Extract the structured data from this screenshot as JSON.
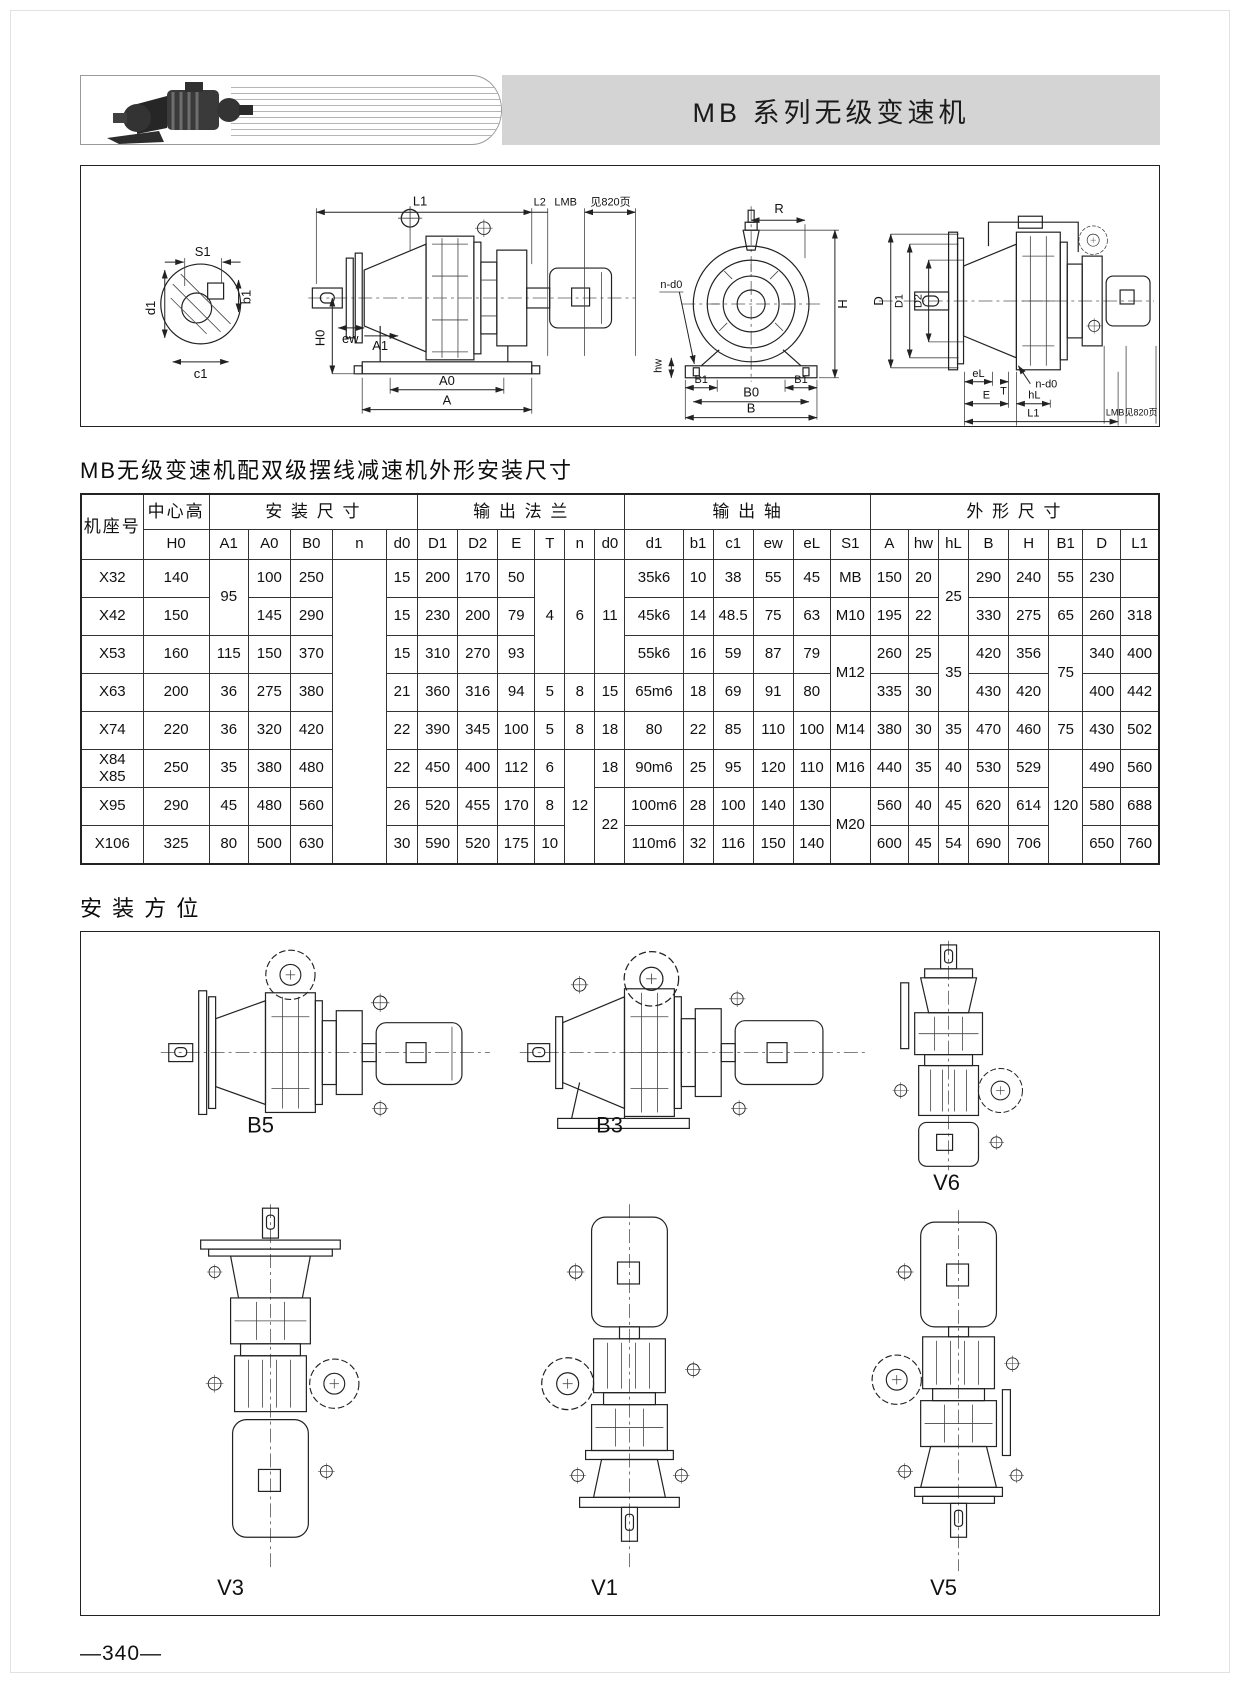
{
  "header": {
    "title": "MB 系列无级变速机"
  },
  "sections": {
    "table_title": "MB无级变速机配双级摆线减速机外形安装尺寸",
    "mounting_title": "安 装 方 位"
  },
  "diagrams": {
    "shaft_section": {
      "s1": "S1",
      "b1": "b1",
      "d1": "d1",
      "c1": "c1"
    },
    "side_view": {
      "l1": "L1",
      "l2": "L2",
      "lmb": "LMB",
      "see_page": "见820页",
      "h0": "H0",
      "ew": "ew",
      "a1": "A1",
      "a0": "A0",
      "a": "A"
    },
    "front_view": {
      "r": "R",
      "h": "H",
      "nd0": "n-d0",
      "hw": "hw",
      "b1": "B1",
      "b0": "B0",
      "b": "B"
    },
    "flange_view": {
      "d": "D",
      "d1": "D1",
      "d2": "D2",
      "el": "eL",
      "t": "T",
      "nd0": "n-d0",
      "e": "E",
      "hl": "hL",
      "lmb": "LMB",
      "see_page": "见820页",
      "l1": "L1"
    }
  },
  "table": {
    "col_model": "机座号",
    "groups": {
      "center_height": "中心高",
      "install": "安 装 尺 寸",
      "flange": "输 出 法 兰",
      "shaft": "输 出 轴",
      "outline": "外 形 尺 寸"
    },
    "sub": [
      "H0",
      "A1",
      "A0",
      "B0",
      "n",
      "d0",
      "D1",
      "D2",
      "E",
      "T",
      "n",
      "d0",
      "d1",
      "b1",
      "c1",
      "ew",
      "eL",
      "S1",
      "A",
      "hw",
      "hL",
      "B",
      "H",
      "B1",
      "D",
      "L1"
    ],
    "rows": [
      {
        "cells": [
          "X32",
          "140",
          "95",
          "100",
          "250",
          "",
          "15",
          "200",
          "170",
          "50",
          "4",
          "6",
          "11",
          "35k6",
          "10",
          "38",
          "55",
          "45",
          "MB",
          "150",
          "20",
          "25",
          "290",
          "240",
          "55",
          "230",
          ""
        ]
      },
      {
        "cells": [
          "X42",
          "150",
          "145",
          "290",
          "15",
          "230",
          "200",
          "79",
          "45k6",
          "14",
          "48.5",
          "75",
          "63",
          "M10",
          "195",
          "22",
          "330",
          "275",
          "65",
          "260",
          "318"
        ]
      },
      {
        "cells": [
          "X53",
          "160",
          "115",
          "150",
          "370",
          "15",
          "310",
          "270",
          "93",
          "55k6",
          "16",
          "59",
          "87",
          "79",
          "M12",
          "260",
          "25",
          "35",
          "420",
          "356",
          "75",
          "340",
          "400"
        ]
      },
      {
        "cells": [
          "X63",
          "200",
          "36",
          "275",
          "380",
          "21",
          "360",
          "316",
          "94",
          "5",
          "8",
          "15",
          "65m6",
          "18",
          "69",
          "91",
          "80",
          "335",
          "30",
          "430",
          "420",
          "400",
          "442"
        ]
      },
      {
        "cells": [
          "X74",
          "220",
          "36",
          "320",
          "420",
          "22",
          "390",
          "345",
          "100",
          "5",
          "8",
          "18",
          "80",
          "22",
          "85",
          "110",
          "100",
          "M14",
          "380",
          "30",
          "35",
          "470",
          "460",
          "75",
          "430",
          "502"
        ]
      },
      {
        "cells": [
          "X84\nX85",
          "250",
          "35",
          "380",
          "480",
          "22",
          "450",
          "400",
          "112",
          "6",
          "12",
          "18",
          "90m6",
          "25",
          "95",
          "120",
          "110",
          "M16",
          "440",
          "35",
          "40",
          "530",
          "529",
          "120",
          "490",
          "560"
        ]
      },
      {
        "cells": [
          "X95",
          "290",
          "45",
          "480",
          "560",
          "26",
          "520",
          "455",
          "170",
          "8",
          "22",
          "100m6",
          "28",
          "100",
          "140",
          "130",
          "M20",
          "560",
          "40",
          "45",
          "620",
          "614",
          "580",
          "688"
        ]
      },
      {
        "cells": [
          "X106",
          "325",
          "80",
          "500",
          "630",
          "30",
          "590",
          "520",
          "175",
          "10",
          "110m6",
          "32",
          "116",
          "150",
          "140",
          "600",
          "45",
          "54",
          "690",
          "706",
          "650",
          "760"
        ]
      }
    ]
  },
  "mounting": {
    "labels": [
      "B5",
      "B3",
      "V6",
      "V3",
      "V1",
      "V5"
    ]
  },
  "page": {
    "number": "—340—"
  }
}
